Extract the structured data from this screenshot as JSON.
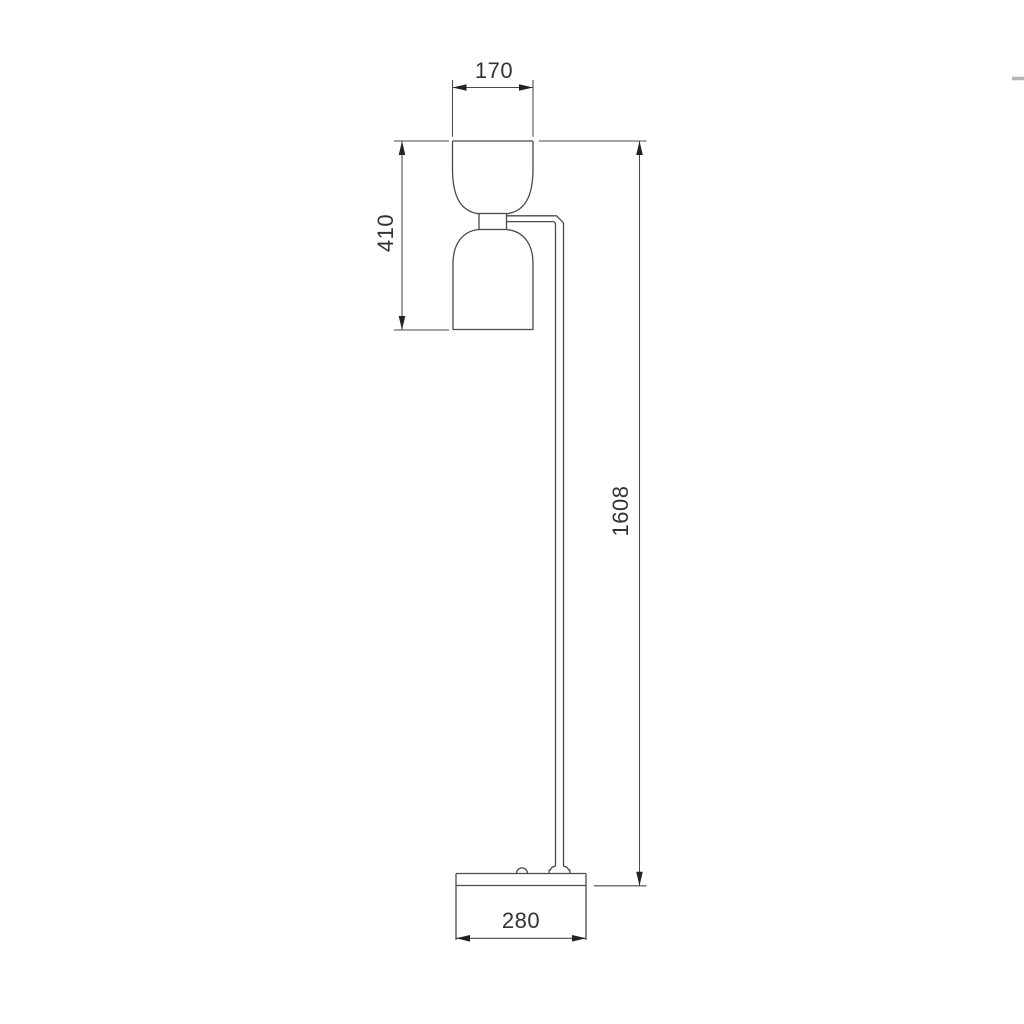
{
  "drawing": {
    "kind": "floor-lamp-dimension-diagram",
    "dimension_labels": {
      "shade_width_mm": "170",
      "head_height_mm": "410",
      "total_height_mm": "1608",
      "base_width_mm": "280"
    },
    "colors": {
      "line": "#4a4a4a",
      "arrow": "#222222",
      "text": "#333333",
      "background": "#ffffff"
    }
  }
}
